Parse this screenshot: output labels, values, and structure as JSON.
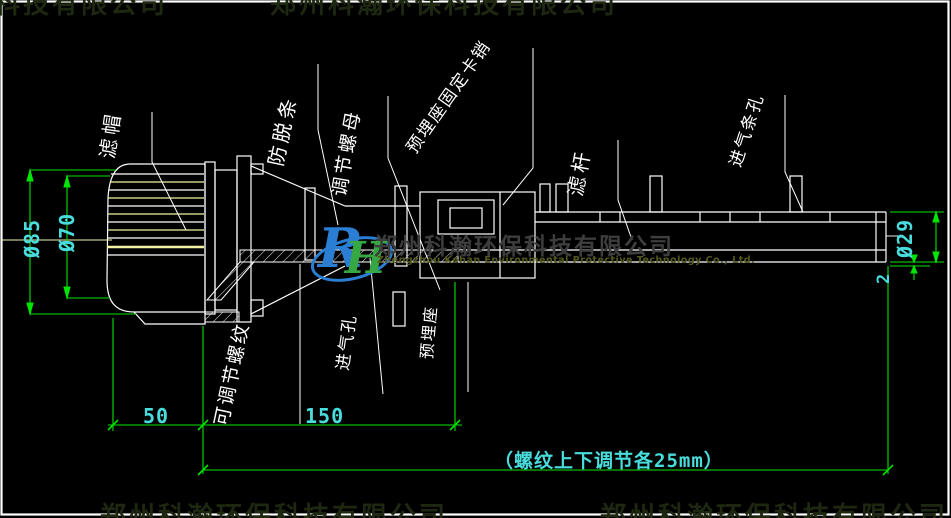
{
  "drawing_title": "长柄滤头安装图",
  "labels": {
    "cap": "滤帽",
    "anti_slip": "防脱条",
    "adjust_nut": "调节螺母",
    "embed_pin": "预埋座固定卡销",
    "rod": "滤杆",
    "air_slots": "进气条孔",
    "adj_thread": "可调节螺纹",
    "air_hole": "进气孔",
    "embed_seat": "预埋座"
  },
  "dims": {
    "cap_outer_dia": "Ø85",
    "cap_inner_dia": "Ø70",
    "len_cap": "50",
    "len_thread": "150",
    "rod_dia": "Ø29",
    "slot_gap": "2",
    "thread_note": "（螺纹上下调节各25mm）"
  },
  "watermark": {
    "logo": "RH",
    "logo_r": "R",
    "logo_h": "H",
    "company_cn": "郑州科瀚环保科技有限公司",
    "company_en": "Zhengzhou Kehan Environmental Protective Technology Co., Ltd."
  },
  "colors": {
    "background": "#000000",
    "outline": "#ffffff",
    "slit_yellow": "#f3f3a3",
    "dim_line_green": "#00e400",
    "dim_text_cyan": "#49dcdc",
    "logo_blue": "#2a7fd4",
    "logo_green": "#35a843",
    "watermark_gray": "#3d3d3d"
  }
}
